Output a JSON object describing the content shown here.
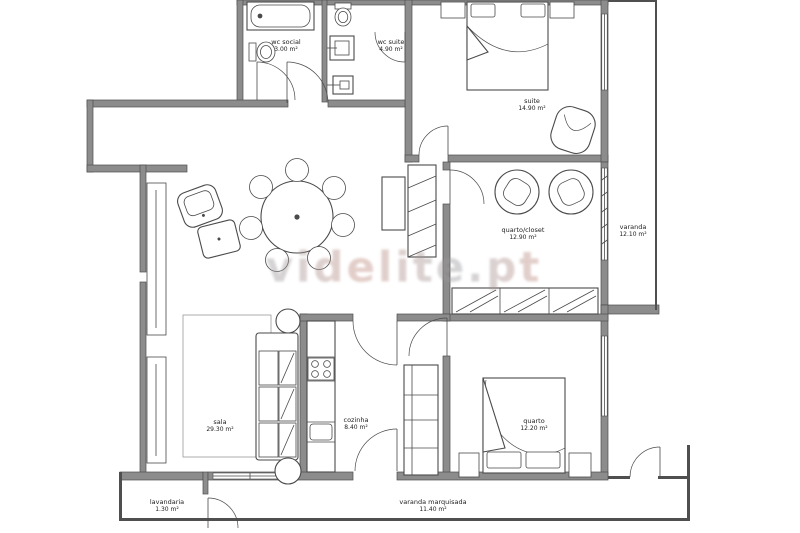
{
  "watermark": {
    "text": "videlite.pt"
  },
  "rooms": [
    {
      "name": "wc social",
      "area": "3.00 m²"
    },
    {
      "name": "wc suite",
      "area": "4.90 m²"
    },
    {
      "name": "suite",
      "area": "14.90 m²"
    },
    {
      "name": "quarto/closet",
      "area": "12.90 m²"
    },
    {
      "name": "varanda",
      "area": "12.10 m²"
    },
    {
      "name": "sala",
      "area": "29.30 m²"
    },
    {
      "name": "cozinha",
      "area": "8.40 m²"
    },
    {
      "name": "quarto",
      "area": "12.20 m²"
    },
    {
      "name": "lavandaria",
      "area": "1.30 m²"
    },
    {
      "name": "varanda marquisada",
      "area": "11.40 m²"
    }
  ],
  "colors": {
    "wall_fill": "#8c8c8c",
    "wall_edge": "#4f4f4f",
    "line": "#4a4a4a",
    "light_line": "#9a9a9a",
    "label": "#222222",
    "watermark_gray": "#97999f",
    "watermark_pink": "#c08a7d"
  }
}
